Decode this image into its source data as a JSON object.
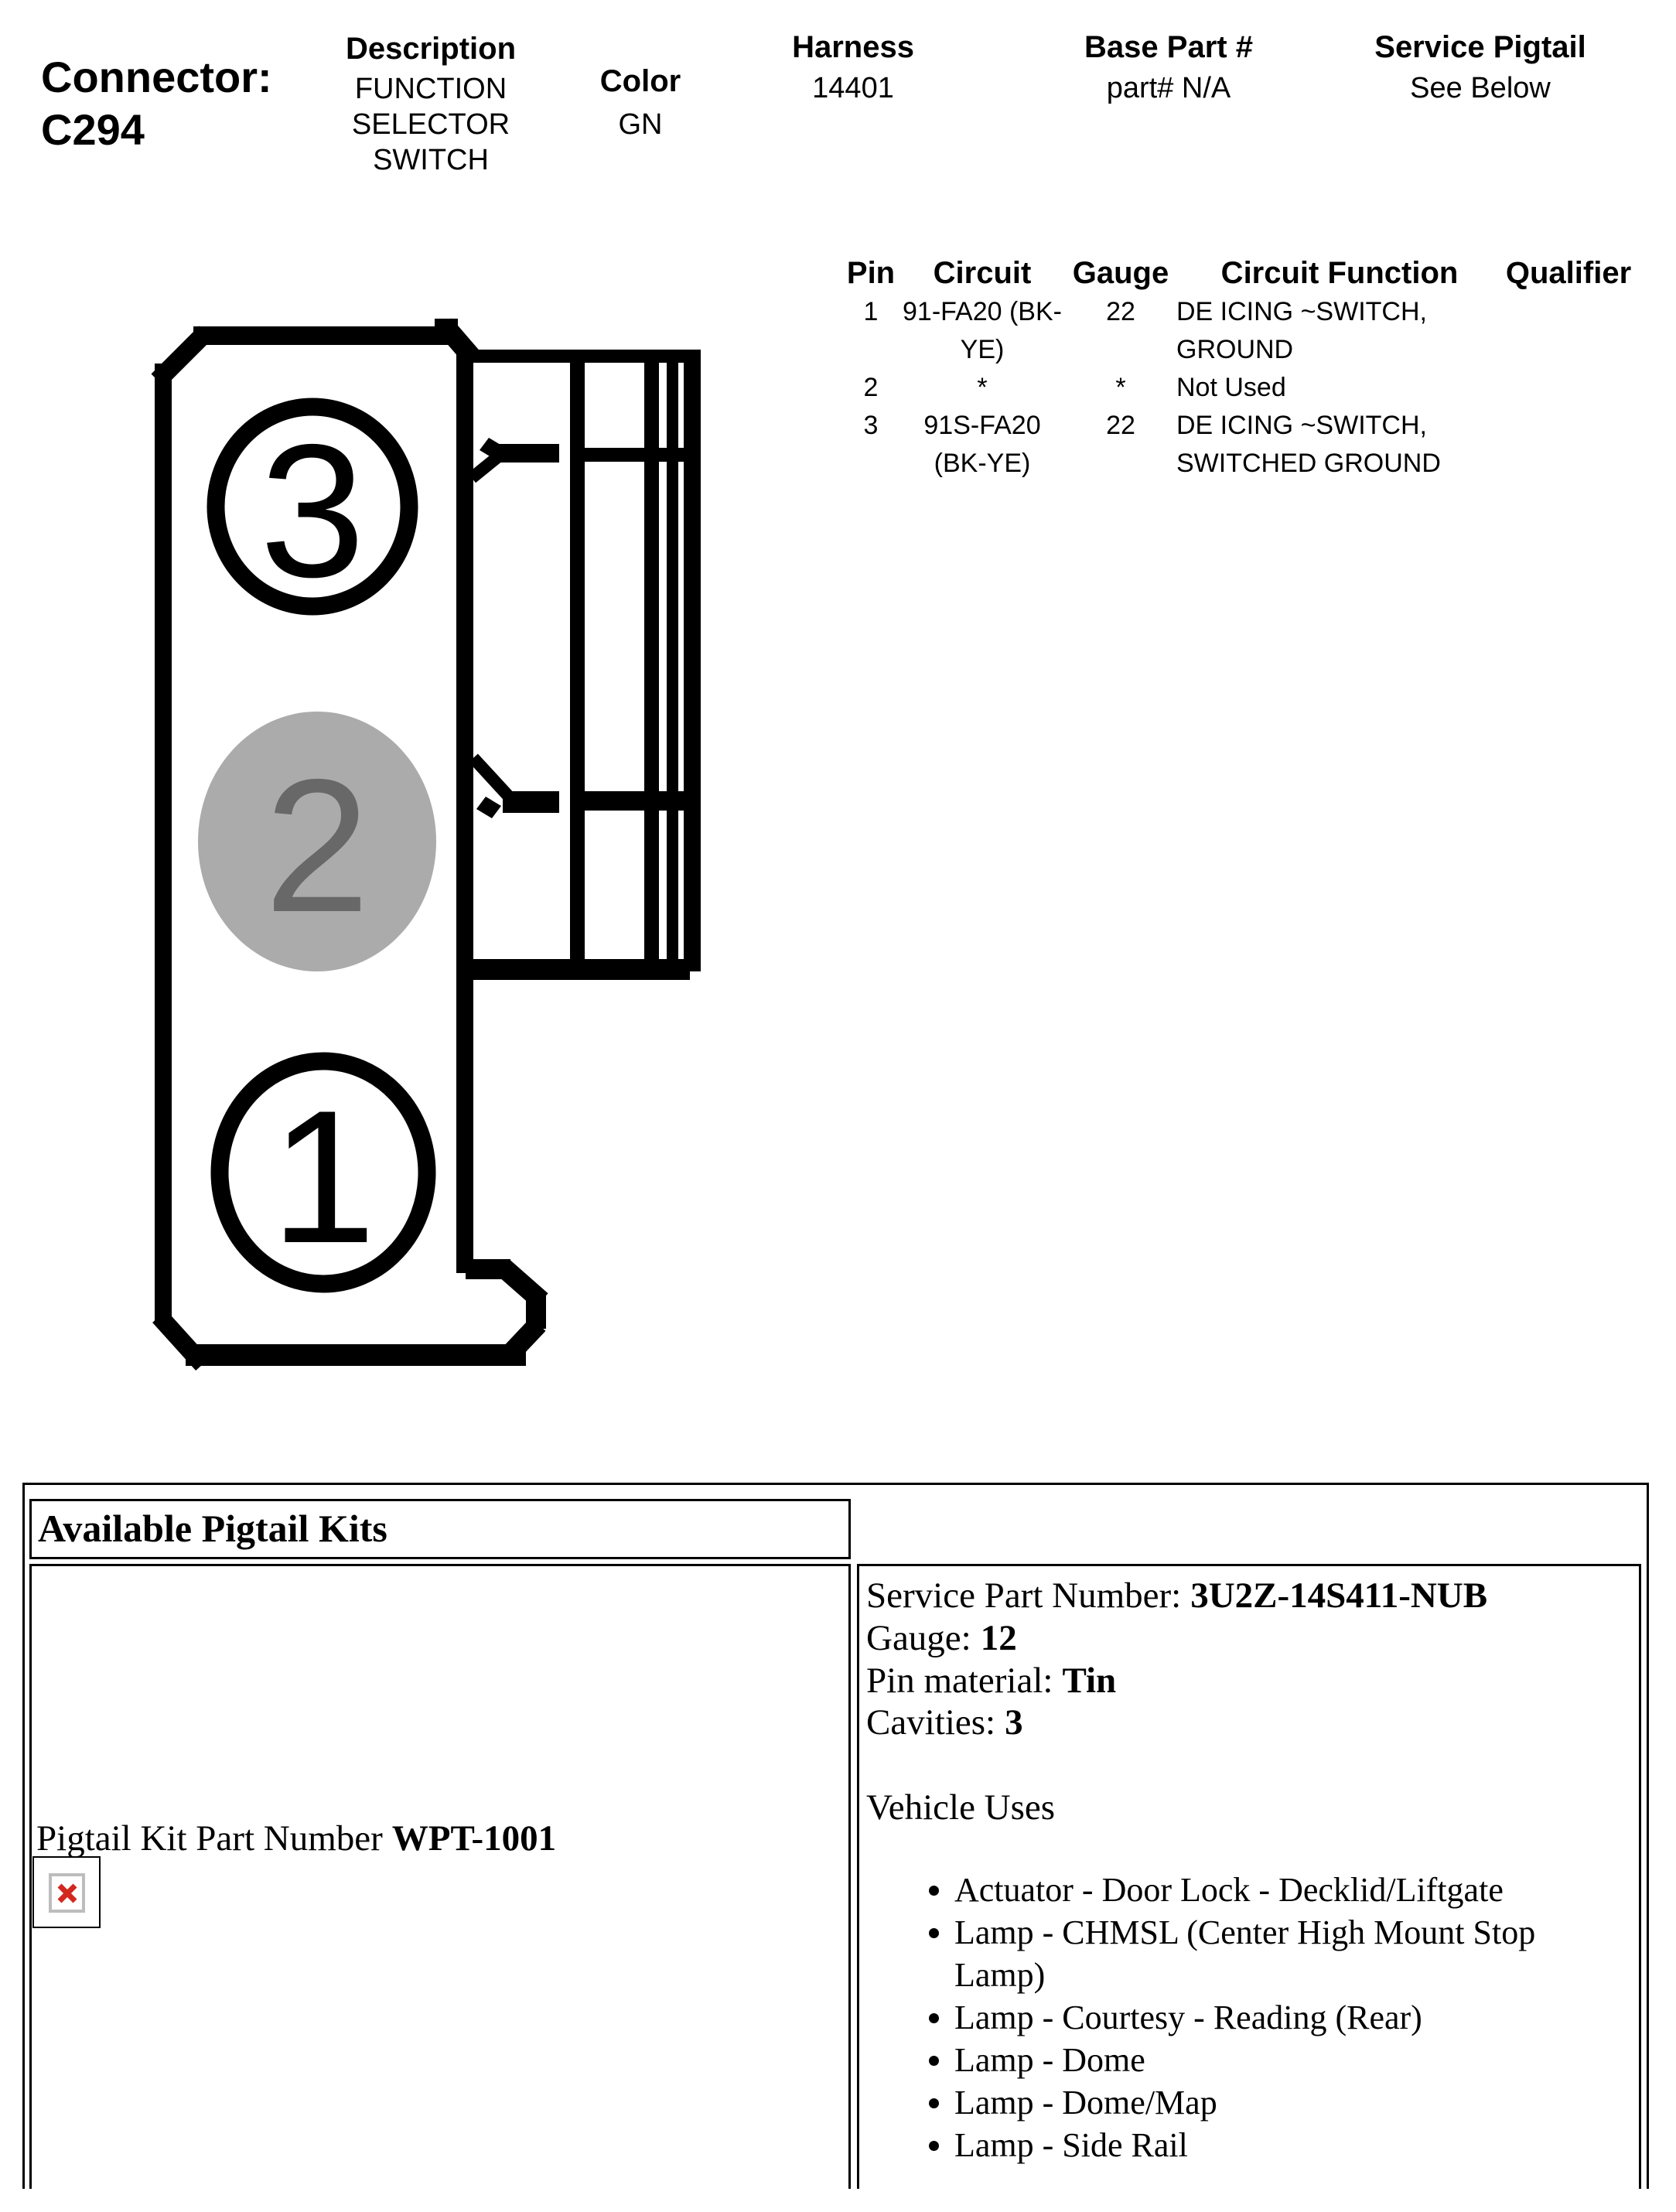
{
  "header": {
    "connector_label": "Connector:",
    "connector_id": "C294",
    "description": {
      "label": "Description",
      "line1": "FUNCTION",
      "line2": "SELECTOR",
      "line3": "SWITCH"
    },
    "color": {
      "label": "Color",
      "value": "GN"
    },
    "harness": {
      "label": "Harness",
      "value": "14401"
    },
    "base_part": {
      "label": "Base Part #",
      "value": "part# N/A"
    },
    "service_pigtail": {
      "label": "Service Pigtail",
      "value": "See Below"
    }
  },
  "pin_table": {
    "headers": {
      "pin": "Pin",
      "circuit": "Circuit",
      "gauge": "Gauge",
      "function": "Circuit Function",
      "qualifier": "Qualifier"
    },
    "rows": [
      {
        "pin": "1",
        "circuit": [
          "91-FA20 (BK-",
          "YE)"
        ],
        "gauge": "22",
        "function": [
          "DE ICING ~SWITCH,",
          "GROUND"
        ],
        "qualifier": ""
      },
      {
        "pin": "2",
        "circuit": [
          "*",
          ""
        ],
        "gauge": "*",
        "function": [
          "Not Used",
          ""
        ],
        "qualifier": ""
      },
      {
        "pin": "3",
        "circuit": [
          "91S-FA20",
          "(BK-YE)"
        ],
        "gauge": "22",
        "function": [
          "DE ICING ~SWITCH,",
          "SWITCHED GROUND"
        ],
        "qualifier": ""
      }
    ]
  },
  "diagram": {
    "cavity_labels": [
      "3",
      "2",
      "1"
    ],
    "colors": {
      "outline": "#000000",
      "cavity2_fill": "#ababab",
      "cavity2_text": "#686868"
    }
  },
  "pigtail_section": {
    "title": "Available Pigtail Kits",
    "kit_label": "Pigtail Kit Part Number",
    "kit_number": "WPT-1001",
    "details": {
      "service_part_label": "Service Part Number:",
      "service_part_value": "3U2Z-14S411-NUB",
      "gauge_label": "Gauge:",
      "gauge_value": "12",
      "pin_material_label": "Pin material:",
      "pin_material_value": "Tin",
      "cavities_label": "Cavities:",
      "cavities_value": "3",
      "vehicle_uses_title": "Vehicle Uses",
      "vehicle_uses": [
        "Actuator - Door Lock - Decklid/Liftgate",
        "Lamp - CHMSL (Center High Mount Stop Lamp)",
        "Lamp - Courtesy - Reading (Rear)",
        "Lamp - Dome",
        "Lamp - Dome/Map",
        "Lamp - Side Rail"
      ]
    },
    "broken_image_color": "#d2281e"
  }
}
